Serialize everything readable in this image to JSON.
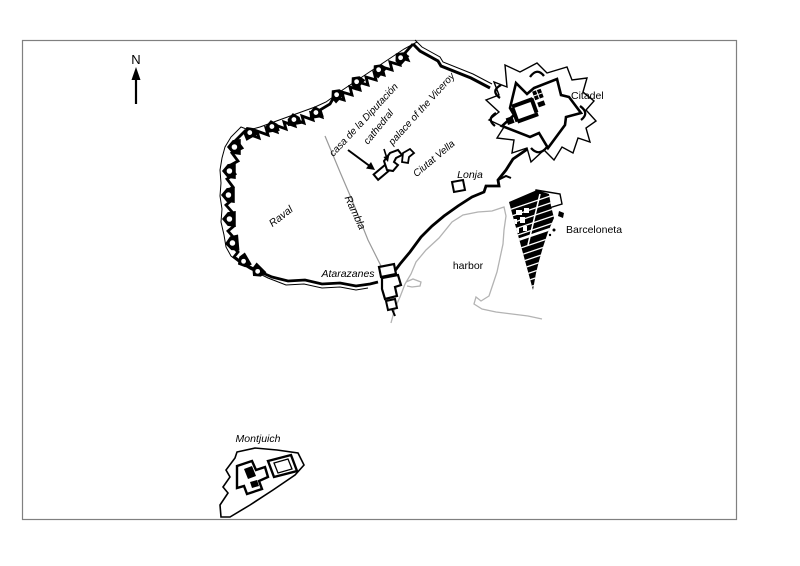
{
  "map": {
    "compass_label": "N",
    "labels": {
      "casa_de_la_diputacion": "casa de la Diputación",
      "cathedral": "cathedral",
      "palace_of_the_viceroy": "palace of the Viceroy",
      "ciutat_vella": "Ciutat Vella",
      "lonja": "Lonja",
      "citadel": "Citadel",
      "barceloneta": "Barceloneta",
      "raval": "Raval",
      "rambla": "Rambla",
      "atarazanes": "Atarazanes",
      "harbor": "harbor",
      "montjuich": "Montjuich"
    },
    "colors": {
      "ink": "#000000",
      "coastline": "#b3b3b3",
      "rambla_line": "#999999",
      "frame": "#808080",
      "background": "#ffffff"
    }
  }
}
